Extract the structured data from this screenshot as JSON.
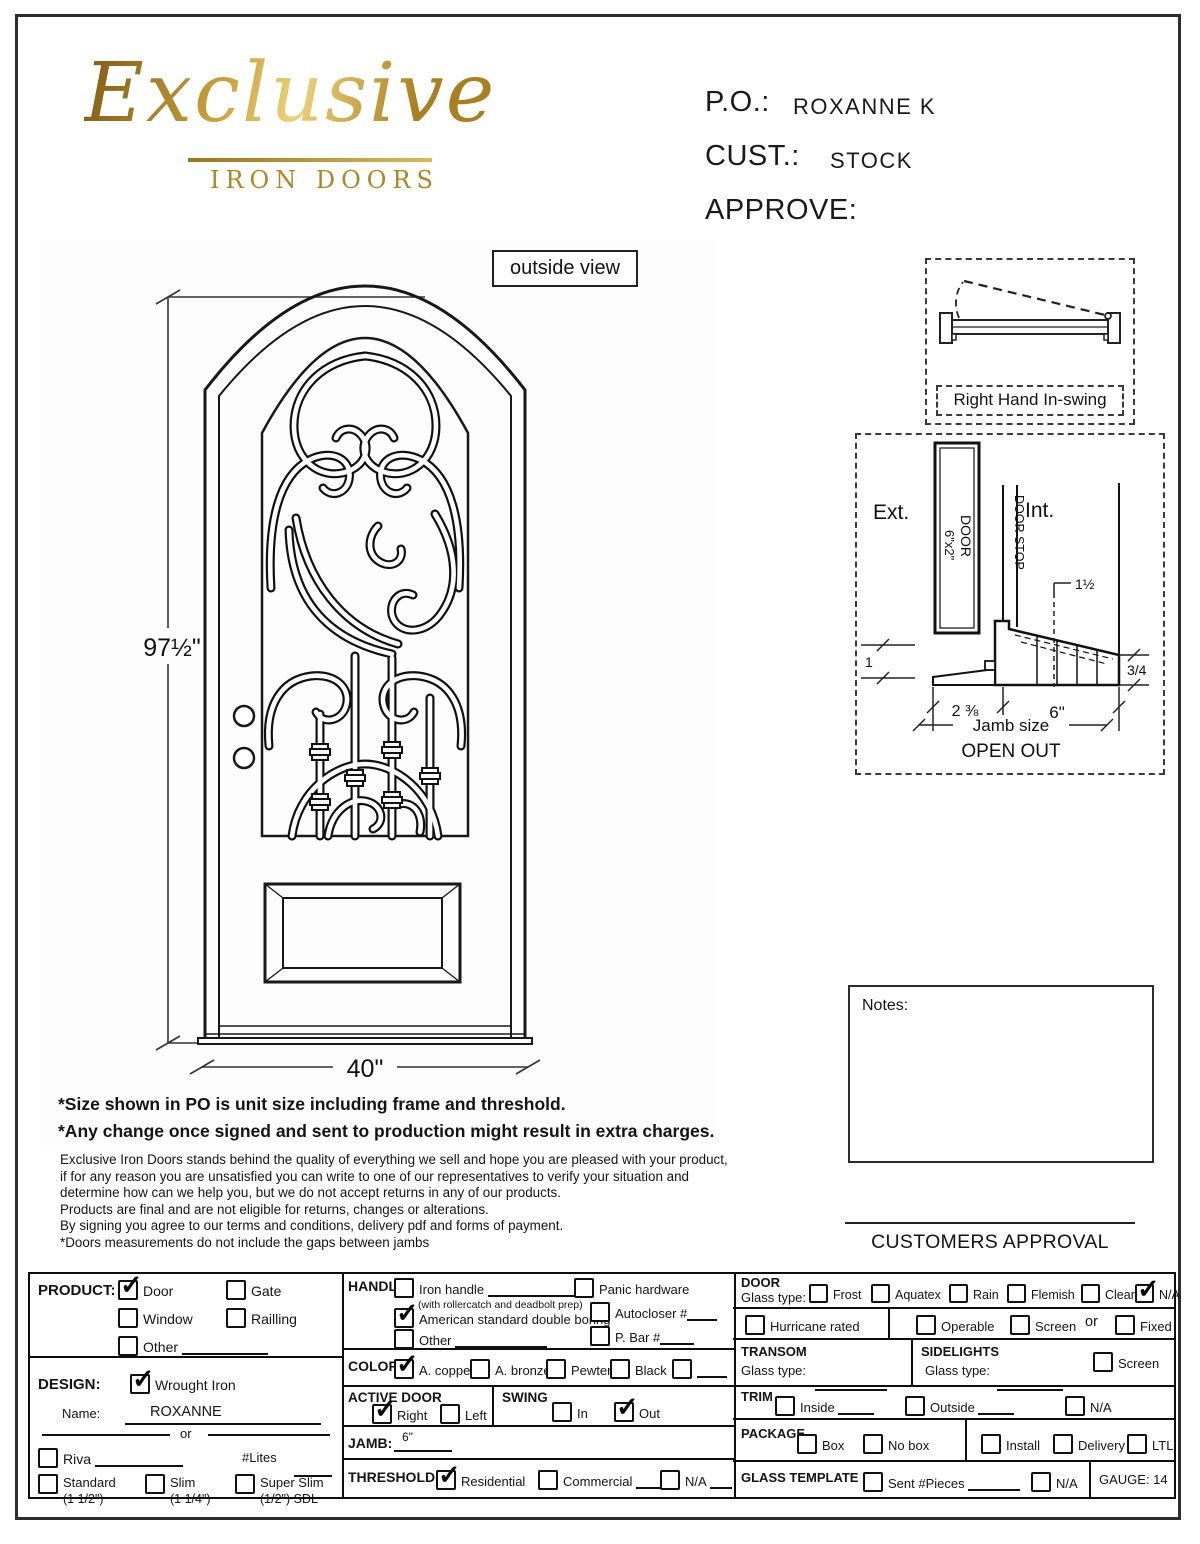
{
  "header": {
    "logo_script": "Exclusive",
    "logo_sub": "IRON DOORS",
    "po_label": "P.O.:",
    "po_value": "ROXANNE K",
    "cust_label": "CUST.:",
    "cust_value": "STOCK",
    "approve_label": "APPROVE:"
  },
  "drawing": {
    "view_label": "outside view",
    "height_dim": "97½\"",
    "width_dim": "40\""
  },
  "swing_diagram": {
    "label": "Right Hand In-swing"
  },
  "jamb_diagram": {
    "ext": "Ext.",
    "int": "Int.",
    "door_line1": "DOOR",
    "door_line2": "6\"x2\"",
    "door_stop": "DOOR STOP",
    "dim_top": "1½",
    "dim_left": "1",
    "dim_right": "3/4",
    "dim_a": "2 ⅜",
    "dim_b": "6\"",
    "jamb_size": "Jamb size",
    "open_out": "OPEN OUT"
  },
  "notes": {
    "label": "Notes:"
  },
  "approval": {
    "label": "CUSTOMERS APPROVAL"
  },
  "disclaimer": {
    "bold1": "*Size shown in PO is unit size including frame and threshold.",
    "bold2": "*Any change once signed and sent to production might result in extra charges.",
    "lines": [
      "Exclusive Iron Doors stands behind the quality of everything we sell and hope you are pleased with your product,",
      "if for any reason you are unsatisfied you can write to one of our representatives to verify your situation and",
      "determine how can we help you, but we do not accept returns in any of our products.",
      "Products are final and are not eligible for returns, changes or alterations.",
      "By signing you agree to our terms and conditions, delivery pdf and forms of payment.",
      "*Doors measurements do not include the gaps between jambs"
    ]
  },
  "form": {
    "product": {
      "label": "PRODUCT:",
      "options": [
        {
          "label": "Door",
          "checked": true
        },
        {
          "label": "Gate",
          "checked": false
        },
        {
          "label": "Window",
          "checked": false
        },
        {
          "label": "Railling",
          "checked": false
        },
        {
          "label": "Other",
          "checked": false
        }
      ]
    },
    "handle": {
      "label": "HANDLE",
      "iron": {
        "label": "Iron handle",
        "checked": false
      },
      "note": "(with rollercatch and deadbolt prep)",
      "american": {
        "label": "American standard double boring",
        "checked": true
      },
      "other": {
        "label": "Other",
        "checked": false
      },
      "panic": {
        "label": "Panic hardware",
        "checked": false
      },
      "autocloser": {
        "label": "Autocloser #",
        "checked": false
      },
      "pbar": {
        "label": "P. Bar #",
        "checked": false
      }
    },
    "design": {
      "label": "DESIGN:",
      "wrought": {
        "label": "Wrought Iron",
        "checked": true
      },
      "name_label": "Name:",
      "name_value": "ROXANNE",
      "or_label": "or"
    },
    "riva": {
      "option": {
        "label": "Riva",
        "checked": false
      },
      "lites_label": "#Lites"
    },
    "profiles": {
      "options": [
        {
          "label": "Standard",
          "sub": "(1 1/2\")",
          "checked": false
        },
        {
          "label": "Slim",
          "sub": "(1 1/4\")",
          "checked": false
        },
        {
          "label": "Super Slim",
          "sub": "(1/2\") SDL",
          "checked": false
        }
      ]
    },
    "color": {
      "label": "COLOR",
      "options": [
        {
          "label": "A. copper",
          "checked": true
        },
        {
          "label": "A. bronze",
          "checked": false
        },
        {
          "label": "Pewter",
          "checked": false
        },
        {
          "label": "Black",
          "checked": false
        },
        {
          "label": "",
          "checked": false
        }
      ]
    },
    "active_door": {
      "label": "ACTIVE DOOR",
      "options": [
        {
          "label": "Right",
          "checked": true
        },
        {
          "label": "Left",
          "checked": false
        }
      ]
    },
    "swing": {
      "label": "SWING",
      "options": [
        {
          "label": "In",
          "checked": false
        },
        {
          "label": "Out",
          "checked": true
        }
      ]
    },
    "jamb": {
      "label": "JAMB:",
      "value": "6\""
    },
    "threshold": {
      "label": "THRESHOLD",
      "options": [
        {
          "label": "Residential",
          "checked": true
        },
        {
          "label": "Commercial",
          "checked": false
        },
        {
          "label": "N/A",
          "checked": false
        }
      ]
    },
    "door_glass": {
      "label": "DOOR",
      "sublabel": "Glass type:",
      "options": [
        {
          "label": "Frost",
          "checked": false
        },
        {
          "label": "Aquatex",
          "checked": false
        },
        {
          "label": "Rain",
          "checked": false
        },
        {
          "label": "Flemish",
          "checked": false
        },
        {
          "label": "Clear",
          "checked": false
        },
        {
          "label": "N/A",
          "checked": true
        }
      ]
    },
    "hurricane": {
      "label": "Hurricane rated",
      "checked": false
    },
    "operable": {
      "options": [
        {
          "label": "Operable",
          "checked": false
        },
        {
          "label": "Screen",
          "checked": false
        }
      ],
      "or_label": "or",
      "fixed": {
        "label": "Fixed",
        "checked": false
      }
    },
    "transom": {
      "label": "TRANSOM",
      "glass_label": "Glass type:"
    },
    "sidelights": {
      "label": "SIDELIGHTS",
      "glass_label": "Glass type:",
      "screen": {
        "label": "Screen",
        "checked": false
      }
    },
    "trim": {
      "label": "TRIM",
      "options": [
        {
          "label": "Inside",
          "checked": false
        },
        {
          "label": "Outside",
          "checked": false
        },
        {
          "label": "N/A",
          "checked": false
        }
      ]
    },
    "package": {
      "label": "PACKAGE",
      "options": [
        {
          "label": "Box",
          "checked": false
        },
        {
          "label": "No box",
          "checked": false
        },
        {
          "label": "Install",
          "checked": false
        },
        {
          "label": "Delivery",
          "checked": false
        },
        {
          "label": "LTL",
          "checked": false
        }
      ]
    },
    "glass_template": {
      "label": "GLASS TEMPLATE",
      "sent": {
        "label": "Sent  #Pieces",
        "checked": false
      },
      "na": {
        "label": "N/A",
        "checked": false
      },
      "gauge": "GAUGE: 14"
    }
  }
}
